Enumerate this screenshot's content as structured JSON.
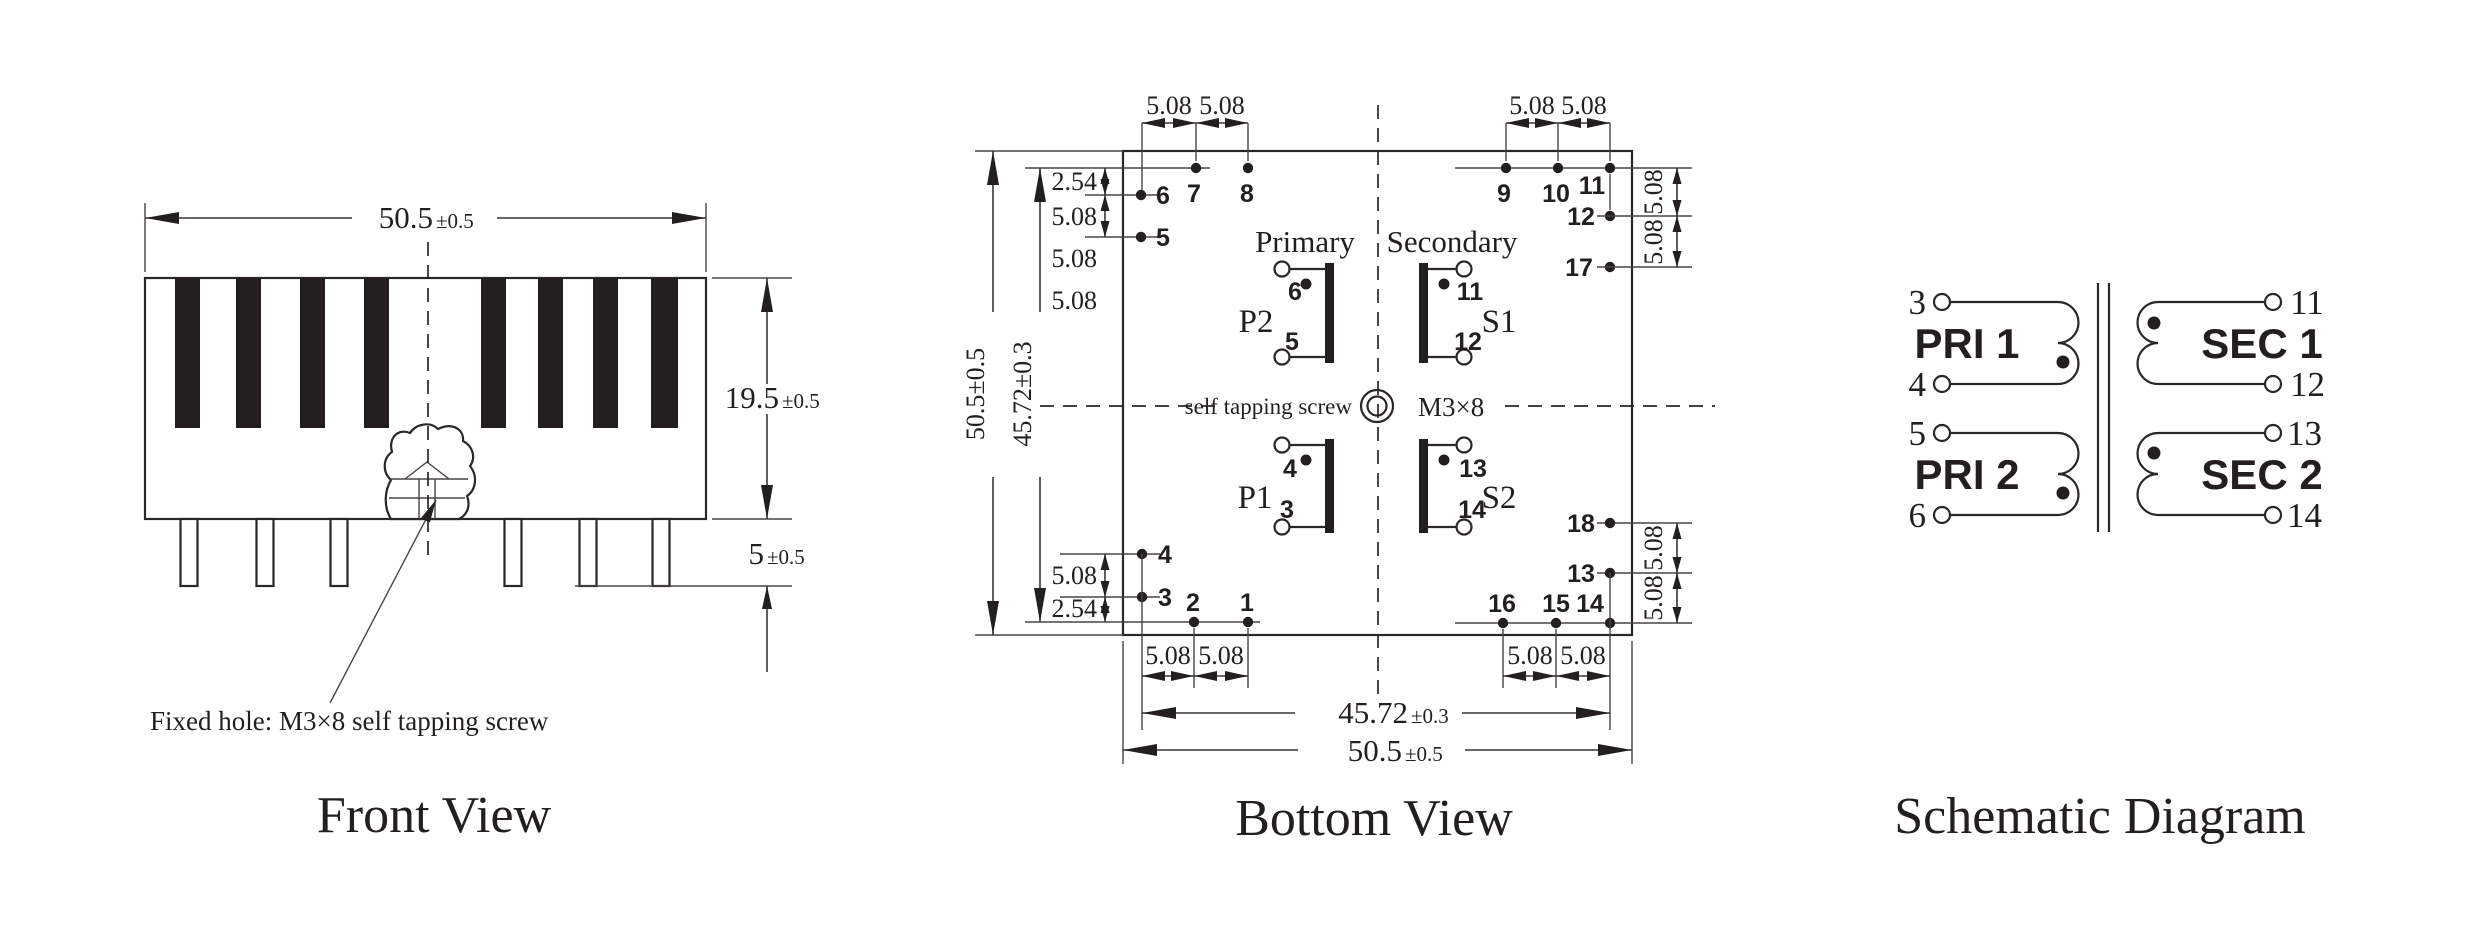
{
  "front_view": {
    "title": "Front View",
    "width_value": "50.5",
    "width_tol": "±0.5",
    "height_value": "19.5",
    "height_tol": "±0.5",
    "pin_value": "5",
    "pin_tol": "±0.5",
    "note": "Fixed hole: M3×8 self tapping screw"
  },
  "bottom_view": {
    "title": "Bottom View",
    "dim_508": "5.08",
    "dim_254": "2.54",
    "overall_left": "50.5±0.5",
    "inner_left": "45.72±0.3",
    "inner_width": "45.72",
    "inner_width_tol": "±0.3",
    "overall_width": "50.5",
    "overall_width_tol": "±0.5",
    "primary_label": "Primary",
    "secondary_label": "Secondary",
    "screw_label": "self tapping screw",
    "screw_size": "M3×8",
    "windings": {
      "p1": "P1",
      "p2": "P2",
      "s1": "S1",
      "s2": "S2"
    },
    "winding_pins": {
      "p2_top": "6",
      "p2_bot": "5",
      "s1_top": "11",
      "s1_bot": "12",
      "p1_top": "4",
      "p1_bot": "3",
      "s2_top": "13",
      "s2_bot": "14"
    },
    "pins": {
      "n1": "1",
      "n2": "2",
      "n3": "3",
      "n4": "4",
      "n5": "5",
      "n6": "6",
      "n7": "7",
      "n8": "8",
      "n9": "9",
      "n10": "10",
      "n11": "11",
      "n12": "12",
      "n13": "13",
      "n14": "14",
      "n15": "15",
      "n16": "16",
      "n17": "17",
      "n18": "18"
    }
  },
  "schematic": {
    "title": "Schematic Diagram",
    "pri1": "PRI 1",
    "pri2": "PRI 2",
    "sec1": "SEC 1",
    "sec2": "SEC 2",
    "pins": {
      "p3": "3",
      "p4": "4",
      "p5": "5",
      "p6": "6",
      "p11": "11",
      "p12": "12",
      "p13": "13",
      "p14": "14"
    }
  }
}
